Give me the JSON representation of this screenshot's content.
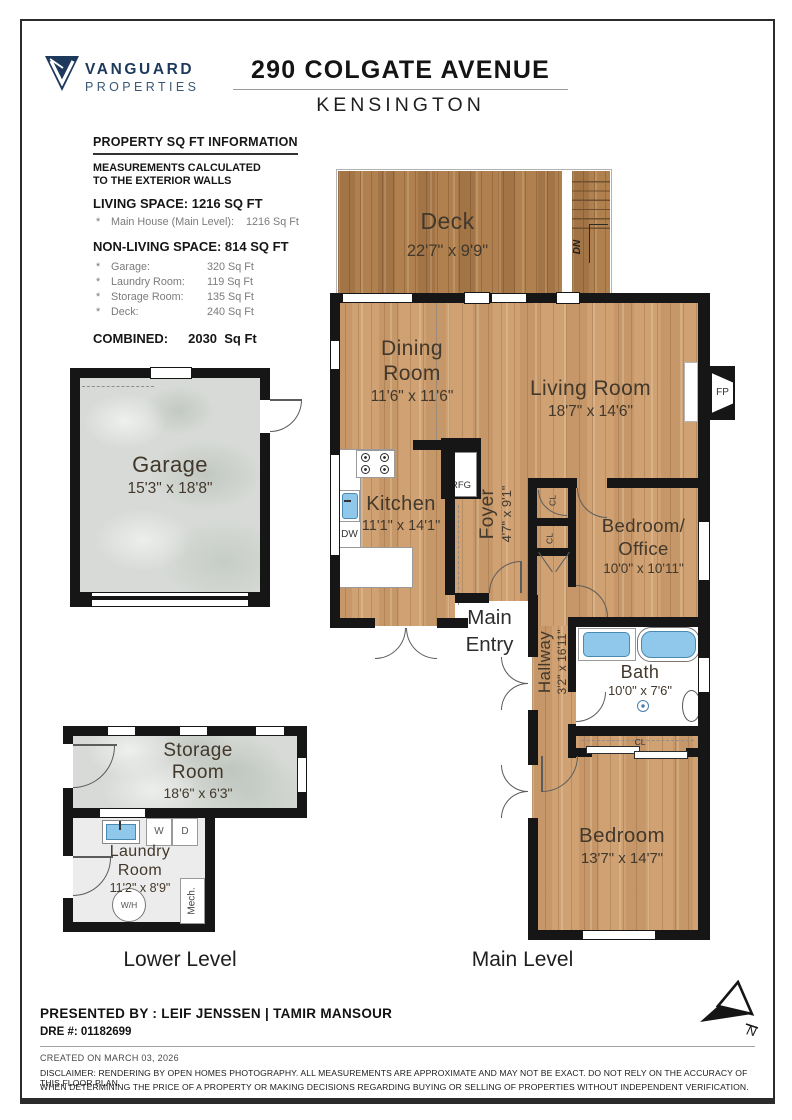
{
  "header": {
    "logo": {
      "line1": "VANGUARD",
      "line2": "PROPERTIES",
      "color": "#1d3a5c"
    },
    "title": "290 COLGATE AVENUE",
    "subtitle": "KENSINGTON"
  },
  "sqft": {
    "heading": "PROPERTY SQ FT INFORMATION",
    "note1": "MEASUREMENTS CALCULATED",
    "note2": "TO THE EXTERIOR WALLS",
    "living_heading": "LIVING SPACE: 1216 SQ FT",
    "bullet": "*",
    "living_label": "Main House (Main Level):",
    "living_value": "1216 Sq Ft",
    "nonliving_heading": "NON-LIVING SPACE: 814 SQ FT",
    "items": [
      {
        "label": "Garage:",
        "value": "320 Sq Ft"
      },
      {
        "label": "Laundry Room:",
        "value": "119 Sq Ft"
      },
      {
        "label": "Storage Room:",
        "value": "135 Sq Ft"
      },
      {
        "label": "Deck:",
        "value": "240 Sq Ft"
      }
    ],
    "combined_label": "COMBINED:",
    "combined_value": "2030  Sq Ft"
  },
  "rooms": {
    "deck": {
      "name": "Deck",
      "dims": "22'7\" x 9'9\""
    },
    "dining": {
      "line1": "Dining",
      "line2": "Room",
      "dims": "11'6\" x 11'6\""
    },
    "living": {
      "name": "Living Room",
      "dims": "18'7\" x 14'6\""
    },
    "kitchen": {
      "name": "Kitchen",
      "dims": "11'1\" x 14'1\""
    },
    "foyer": {
      "name": "Foyer",
      "dims": "4'7\" x 9'1\""
    },
    "office": {
      "line1": "Bedroom/",
      "line2": "Office",
      "dims": "10'0\" x 10'11\""
    },
    "bath": {
      "name": "Bath",
      "dims": "10'0\" x 7'6\""
    },
    "hallway": {
      "name": "Hallway",
      "dims": "3'2\" x 16'11\""
    },
    "bedroom": {
      "name": "Bedroom",
      "dims": "13'7\" x 14'7\""
    },
    "garage": {
      "name": "Garage",
      "dims": "15'3\" x 18'8\""
    },
    "storage": {
      "line1": "Storage",
      "line2": "Room",
      "dims": "18'6\" x 6'3\""
    },
    "laundry": {
      "line1": "Laundry",
      "line2": "Room",
      "dims": "11'2\" x 8'9\""
    },
    "main_entry": {
      "line1": "Main",
      "line2": "Entry"
    }
  },
  "tags": {
    "dn": "DN",
    "fp": "FP",
    "rfg": "RFG",
    "dw": "DW",
    "cl": "CL",
    "washer": "W",
    "dryer": "D",
    "wh": "W/H",
    "mech": "Mech.",
    "north": "N"
  },
  "levels": {
    "lower": "Lower Level",
    "main": "Main Level"
  },
  "footer": {
    "presented_by": "PRESENTED BY : LEIF JENSSEN | TAMIR MANSOUR",
    "dre": "DRE #: 01182699",
    "created": "CREATED ON MARCH 03, 2026",
    "disclaimer1": "DISCLAIMER: RENDERING BY OPEN HOMES PHOTOGRAPHY. ALL MEASUREMENTS ARE APPROXIMATE AND MAY NOT BE EXACT. DO NOT RELY ON THE ACCURACY OF THIS FLOOR PLAN",
    "disclaimer2": "WHEN DETERMINING THE PRICE OF A PROPERTY OR MAKING DECISIONS REGARDING BUYING OR SELLING OF PROPERTIES WITHOUT INDEPENDENT VERIFICATION."
  },
  "colors": {
    "wood": "#cfa173",
    "deck_wood": "#b0814f",
    "concrete": "#d7dad6",
    "wall": "#161616",
    "fixture_blue": "#8fc8ea",
    "brand_navy": "#1d3a5c"
  }
}
